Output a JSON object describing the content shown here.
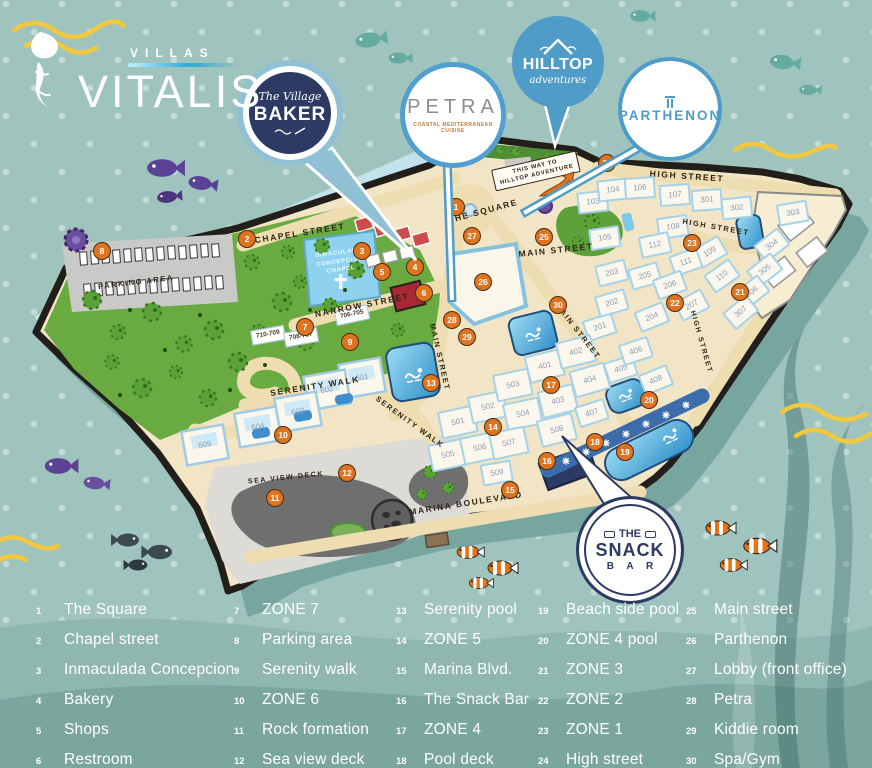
{
  "colors": {
    "background": "#9fc3bd",
    "island_sand": "#f2e5c6",
    "park_green": "#69aa41",
    "pool_blue": "#2d8fc9",
    "marker_orange": "#df7420",
    "navy": "#2c3a64",
    "badge_blue": "#4f9cc9",
    "wave_yellow": "#f1c83e"
  },
  "logo": {
    "villas": "VILLAS",
    "vitalis": "VITALIS"
  },
  "badges": {
    "baker": {
      "top": "The Village",
      "name": "BAKER"
    },
    "petra": {
      "name": "PETRA",
      "tagline": "COASTAL MEDITERRANEAN CUISINE"
    },
    "hilltop": {
      "name": "HILLTOP",
      "sub": "adventures"
    },
    "parthenon": {
      "name": "PARTHENON"
    },
    "snack": {
      "line1": "THE",
      "line2": "SNACK",
      "line3": "B A R"
    }
  },
  "map": {
    "sign1": "THIS WAY TO",
    "sign2": "HILLTOP ADVENTURE",
    "chapel_label": "INMACULADA CONCEPCION CHAPEL",
    "streets": {
      "chapel": "CHAPEL STREET",
      "narrow": "NARROW STREET",
      "serenity": "SERENITY WALK",
      "square": "THE SQUARE",
      "main": "MAIN STREET",
      "high": "HIGH STREET",
      "marina": "MARINA BOULEVARD",
      "parking": "PARKING AREA",
      "seaview": "SEA VIEW DECK"
    },
    "buildings": {
      "zone1": [
        "103",
        "104",
        "105",
        "106",
        "107",
        "108",
        "109",
        "110",
        "111",
        "112"
      ],
      "zone2": [
        "201",
        "202",
        "203",
        "204",
        "205",
        "206",
        "207"
      ],
      "zone3": [
        "301",
        "302",
        "303",
        "304",
        "305",
        "306",
        "307"
      ],
      "zone4": [
        "401",
        "402",
        "403",
        "404",
        "405",
        "406",
        "407",
        "408"
      ],
      "zone5": [
        "501",
        "502",
        "503",
        "504",
        "505",
        "506",
        "507",
        "508",
        "509"
      ],
      "zone6": [
        "601",
        "602",
        "603",
        "604",
        "605"
      ],
      "zone7": [
        "710-709",
        "708-707",
        "706-705"
      ]
    }
  },
  "legend": {
    "items": [
      {
        "num": "1",
        "label": "The Square"
      },
      {
        "num": "2",
        "label": "Chapel street"
      },
      {
        "num": "3",
        "label": "Inmaculada Concepcion"
      },
      {
        "num": "4",
        "label": "Bakery"
      },
      {
        "num": "5",
        "label": "Shops"
      },
      {
        "num": "6",
        "label": "Restroom"
      },
      {
        "num": "7",
        "label": "ZONE 7"
      },
      {
        "num": "8",
        "label": "Parking area"
      },
      {
        "num": "9",
        "label": "Serenity walk"
      },
      {
        "num": "10",
        "label": "ZONE 6"
      },
      {
        "num": "11",
        "label": "Rock formation"
      },
      {
        "num": "12",
        "label": "Sea view deck"
      },
      {
        "num": "13",
        "label": "Serenity pool"
      },
      {
        "num": "14",
        "label": "ZONE 5"
      },
      {
        "num": "15",
        "label": "Marina Blvd."
      },
      {
        "num": "16",
        "label": "The Snack Bar"
      },
      {
        "num": "17",
        "label": "ZONE 4"
      },
      {
        "num": "18",
        "label": "Pool deck"
      },
      {
        "num": "19",
        "label": "Beach side pool"
      },
      {
        "num": "20",
        "label": "ZONE 4 pool"
      },
      {
        "num": "21",
        "label": "ZONE 3"
      },
      {
        "num": "22",
        "label": "ZONE 2"
      },
      {
        "num": "23",
        "label": "ZONE 1"
      },
      {
        "num": "24",
        "label": "High street"
      },
      {
        "num": "25",
        "label": "Main street"
      },
      {
        "num": "26",
        "label": "Parthenon"
      },
      {
        "num": "27",
        "label": "Lobby (front office)"
      },
      {
        "num": "28",
        "label": "Petra"
      },
      {
        "num": "29",
        "label": "Kiddie room"
      },
      {
        "num": "30",
        "label": "Spa/Gym"
      }
    ]
  }
}
